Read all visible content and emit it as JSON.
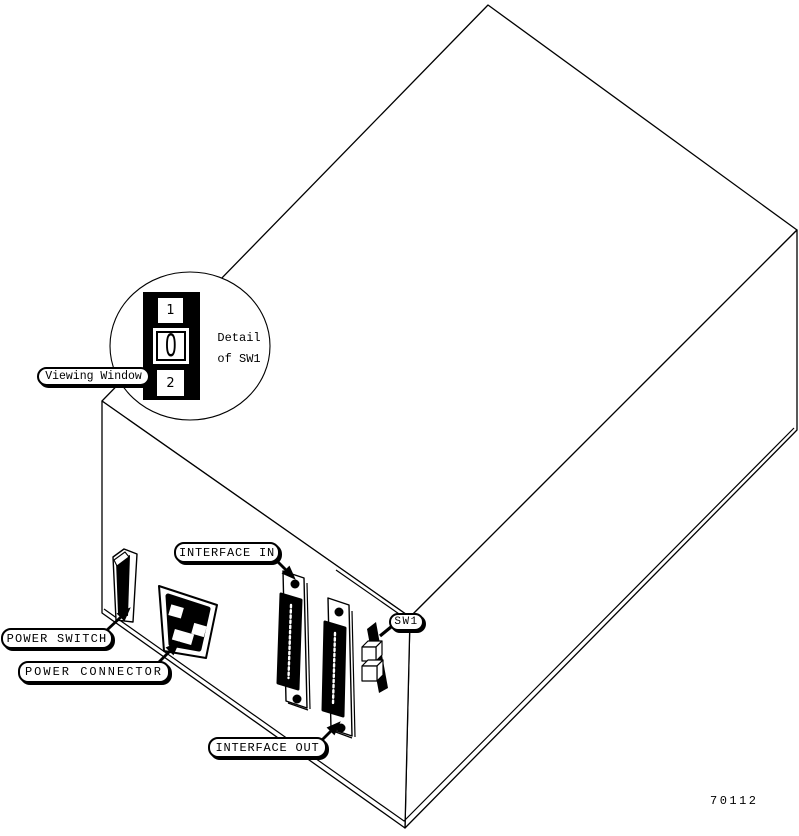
{
  "figure": {
    "number": "70112"
  },
  "labels": {
    "viewing_window": "Viewing Window",
    "interface_in": "INTERFACE IN",
    "interface_out": "INTERFACE OUT",
    "power_switch": "POWER SWITCH",
    "power_connector": "POWER CONNECTOR",
    "sw1": "SW1"
  },
  "detail_callout": {
    "line1": "Detail",
    "line2": "of SW1"
  },
  "switch_detail": {
    "position_top": "1",
    "position_middle": "0",
    "position_bottom": "2"
  },
  "colors": {
    "line": "#000000",
    "background": "#ffffff"
  }
}
